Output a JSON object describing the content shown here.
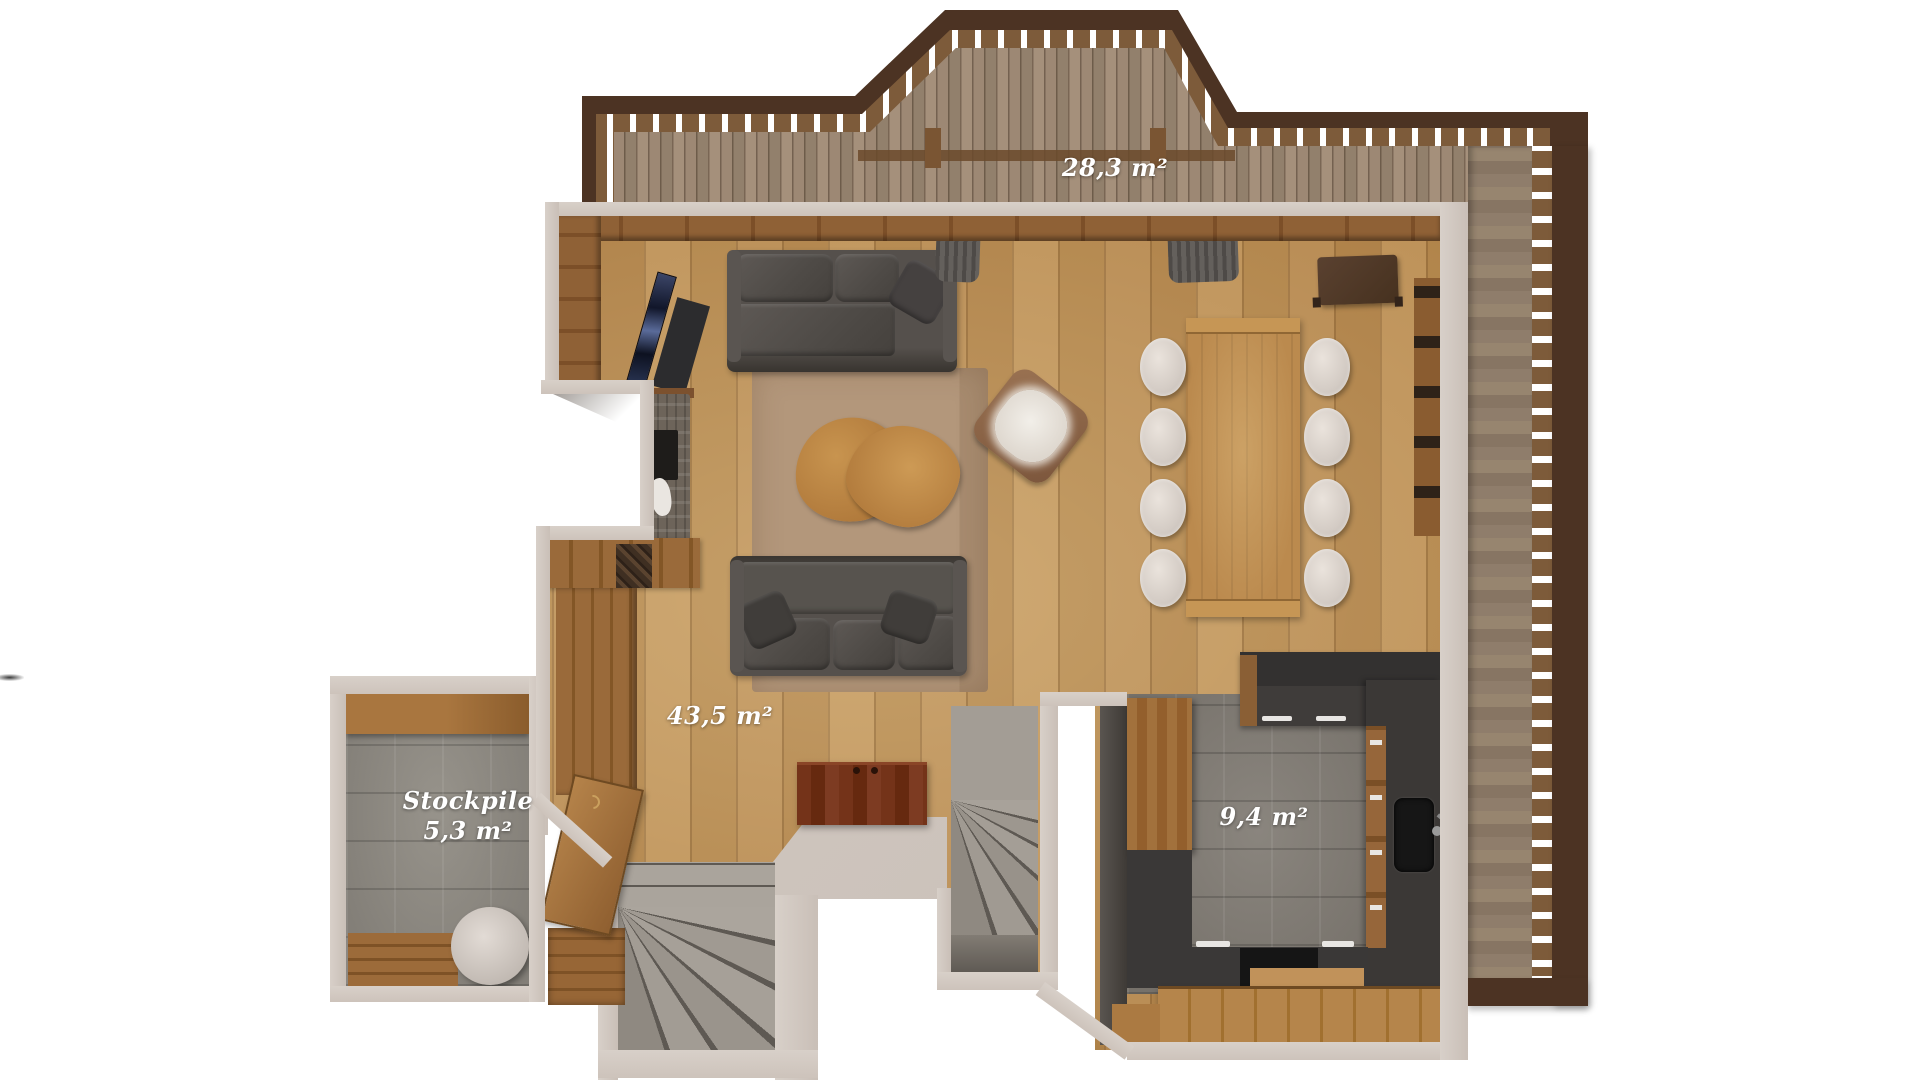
{
  "title": "Floor plan render",
  "rooms": [
    {
      "id": "terrace",
      "area_label": "28,3 m²"
    },
    {
      "id": "living-room",
      "area_label": "43,5 m²"
    },
    {
      "id": "stockpile",
      "name": "Stockpile",
      "area_label": "5,3 m²"
    },
    {
      "id": "kitchen",
      "area_label": "9,4 m²"
    }
  ],
  "colors": {
    "background": "#ffffff",
    "wall": "#d2c9c2",
    "deck_rail_dark": "#4c3323",
    "deck_plank": "#9a8571",
    "living_floor": "#b3864e",
    "rug": "#b3977b",
    "sofa": "#4c4844",
    "coffee_table": "#bb8449",
    "dining_table": "#bb8a4e",
    "chair": "#dcd5cf",
    "tile_stockpile": "#8c8880",
    "tile_kitchen": "#7f7a73",
    "counter_charcoal": "#3b3836",
    "cabinet_mahogany": "#6f3015",
    "stairs_gray": "#9d978f",
    "label_text": "#ffffff"
  }
}
